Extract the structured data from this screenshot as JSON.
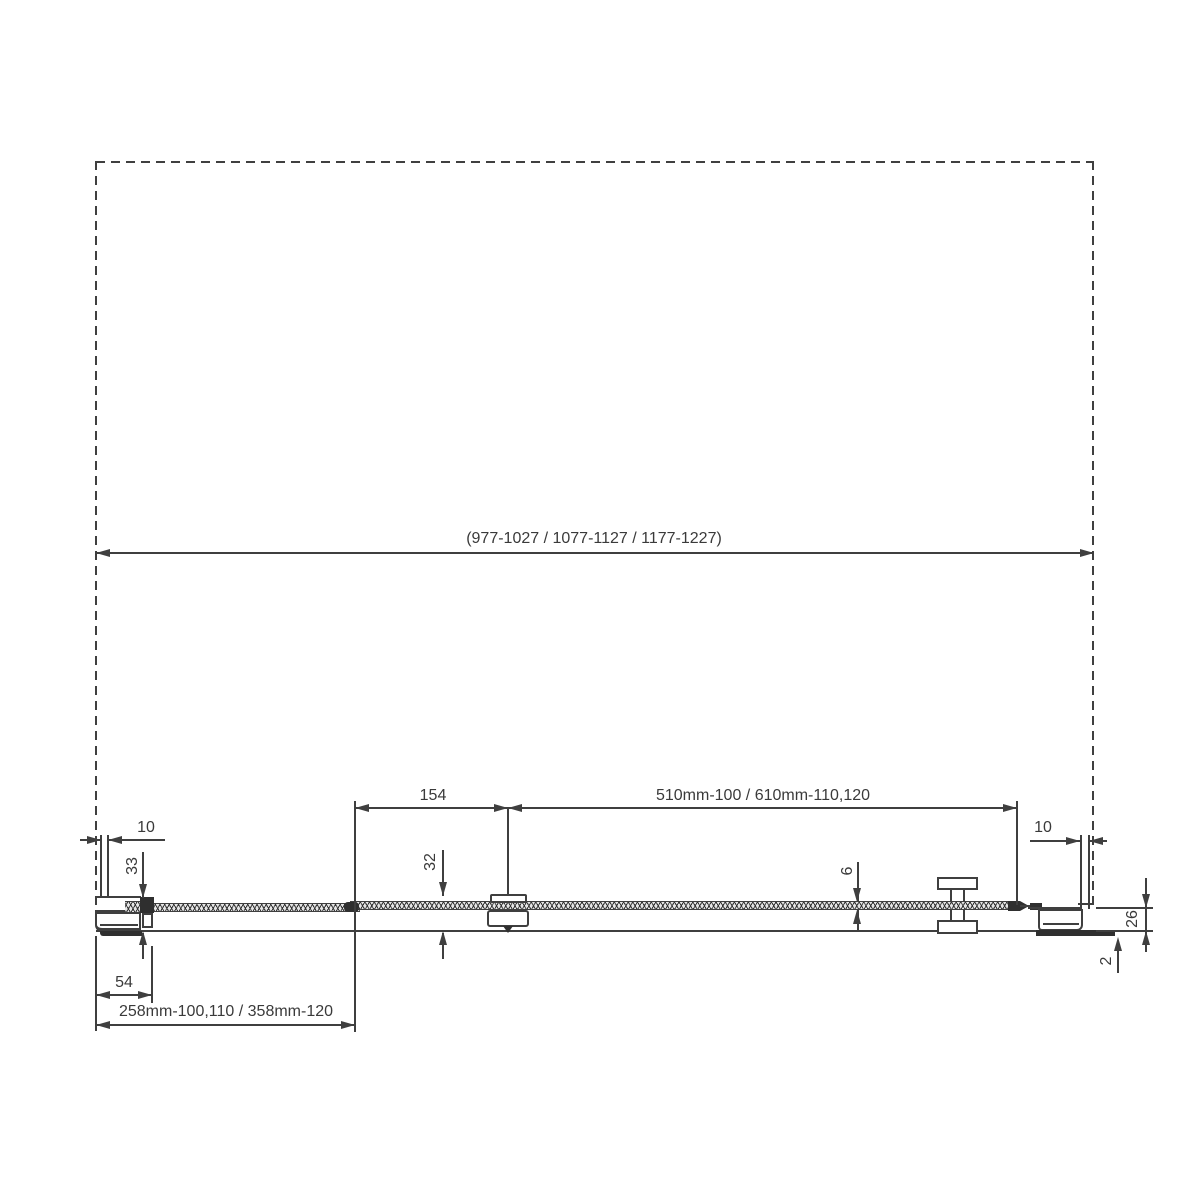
{
  "drawing": {
    "title": "shower-door-horizontal-cross-section",
    "line_color": "#3f3f3f",
    "text_color": "#3a3a3a",
    "background": "#ffffff"
  },
  "dimensions": {
    "overall_width_range": "(977-1027 / 1077-1127 / 1177-1227)",
    "left_wall_clearance": "10",
    "left_profile_depth": "33",
    "left_profile_foot_width": "54",
    "fixed_panel_width": "258mm-100,110 / 358mm-120",
    "clamp_offset": "154",
    "door_panel_width": "510mm-100 / 610mm-110,120",
    "clamp_depth": "32",
    "glass_thickness": "6",
    "right_wall_clearance": "10",
    "right_profile_depth": "26",
    "bottom_gap": "2"
  }
}
